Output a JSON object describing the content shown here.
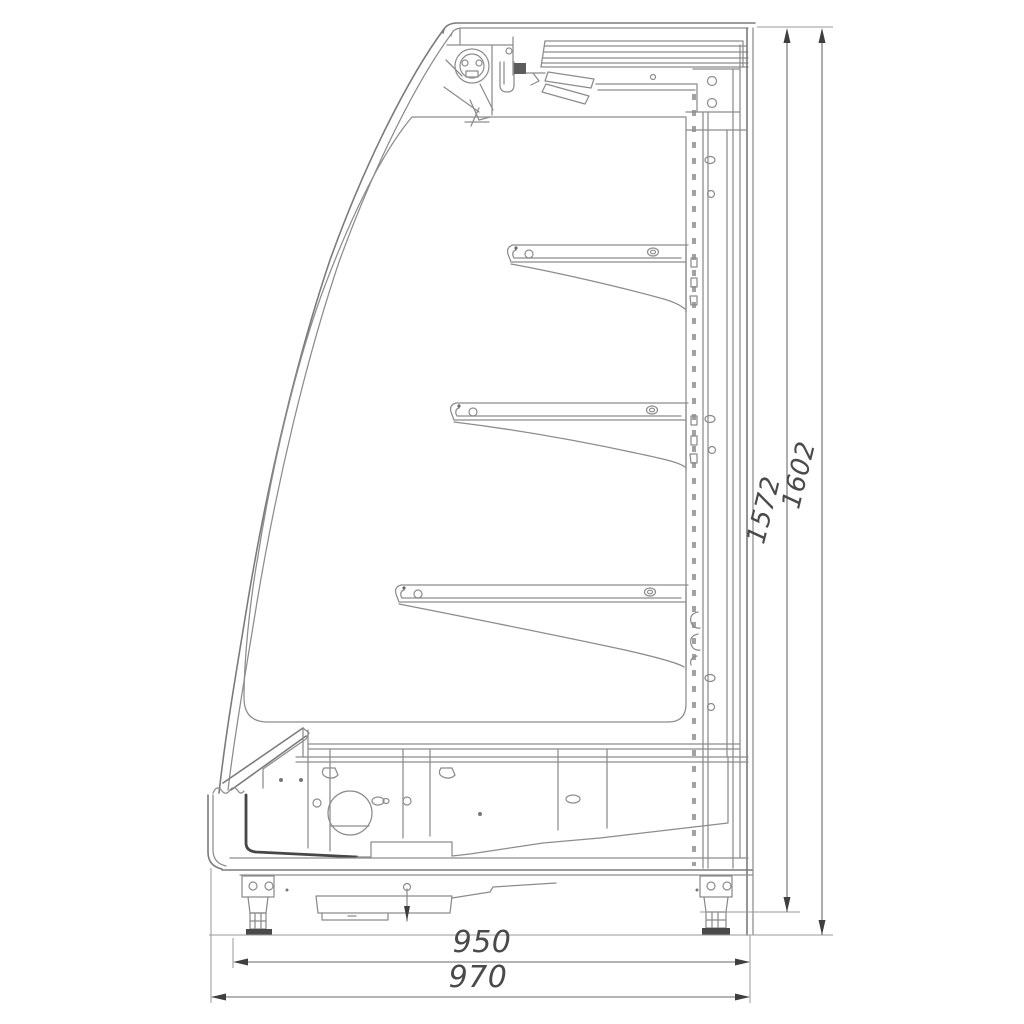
{
  "drawing": {
    "dimensions": {
      "height_inner": "1572",
      "height_overall": "1602",
      "width_inner": "950",
      "width_overall": "970"
    },
    "colors": {
      "line": "#8c8c8c",
      "dark": "#474747",
      "dimension_text": "#4a4a4a",
      "background": "#ffffff"
    }
  }
}
